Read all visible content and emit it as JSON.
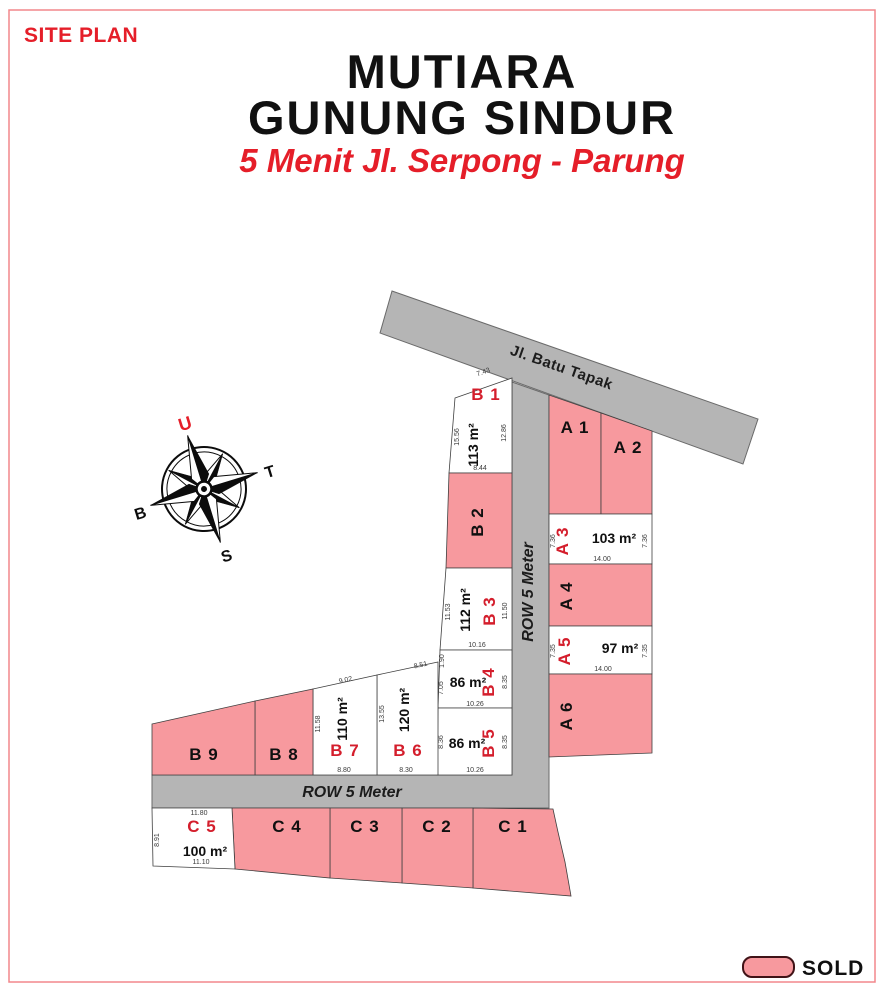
{
  "header": {
    "site_plan_label": "SITE PLAN",
    "title_line1": "MUTIARA",
    "title_line2": "GUNUNG SINDUR",
    "subtitle": "5 Menit Jl. Serpong - Parung"
  },
  "compass": {
    "north": "U",
    "east": "T",
    "south": "S",
    "west": "B"
  },
  "roads": {
    "main_road": "Jl. Batu Tapak",
    "row_vertical": "ROW 5 Meter",
    "row_horizontal": "ROW 5 Meter"
  },
  "legend": {
    "sold_label": "SOLD",
    "sold_color": "#f7999e"
  },
  "lots": [
    {
      "id": "B1",
      "label": "B 1",
      "status": "available",
      "area": "113 m²",
      "dims": {
        "top": "7.43",
        "left": "15.56",
        "right": "12.86",
        "bottom": "8.44"
      }
    },
    {
      "id": "B2",
      "label": "B 2",
      "status": "sold"
    },
    {
      "id": "B3",
      "label": "B 3",
      "status": "available",
      "area": "112 m²",
      "dims": {
        "left": "11.53",
        "right": "11.50",
        "bottom": "10.16"
      }
    },
    {
      "id": "B4",
      "label": "B 4",
      "status": "available",
      "area": "86 m²",
      "dims": {
        "top_left": "1.90",
        "left": "7.05",
        "right": "8.35",
        "bottom": "10.26"
      }
    },
    {
      "id": "B5",
      "label": "B 5",
      "status": "available",
      "area": "86 m²",
      "dims": {
        "left": "8.36",
        "right": "8.35",
        "bottom": "10.26"
      }
    },
    {
      "id": "B6",
      "label": "B 6",
      "status": "available",
      "area": "120 m²",
      "dims": {
        "top": "8.51",
        "left": "13.55",
        "bottom": "8.30"
      }
    },
    {
      "id": "B7",
      "label": "B 7",
      "status": "available",
      "area": "110 m²",
      "dims": {
        "top": "9.02",
        "left": "11.58",
        "bottom": "8.80"
      }
    },
    {
      "id": "B8",
      "label": "B 8",
      "status": "sold"
    },
    {
      "id": "B9",
      "label": "B 9",
      "status": "sold"
    },
    {
      "id": "A1",
      "label": "A 1",
      "status": "sold"
    },
    {
      "id": "A2",
      "label": "A 2",
      "status": "sold"
    },
    {
      "id": "A3",
      "label": "A 3",
      "status": "available",
      "area": "103 m²",
      "dims": {
        "left": "7.36",
        "right": "7.36",
        "bottom": "14.00"
      }
    },
    {
      "id": "A4",
      "label": "A 4",
      "status": "sold"
    },
    {
      "id": "A5",
      "label": "A 5",
      "status": "available",
      "area": "97 m²",
      "dims": {
        "left": "7.35",
        "right": "7.35",
        "bottom": "14.00"
      }
    },
    {
      "id": "A6",
      "label": "A 6",
      "status": "sold"
    },
    {
      "id": "C1",
      "label": "C 1",
      "status": "sold"
    },
    {
      "id": "C2",
      "label": "C 2",
      "status": "sold"
    },
    {
      "id": "C3",
      "label": "C 3",
      "status": "sold"
    },
    {
      "id": "C4",
      "label": "C 4",
      "status": "sold"
    },
    {
      "id": "C5",
      "label": "C 5",
      "status": "available",
      "area": "100 m²",
      "dims": {
        "top": "11.80",
        "left": "8.91",
        "bottom": "11.10"
      }
    }
  ]
}
